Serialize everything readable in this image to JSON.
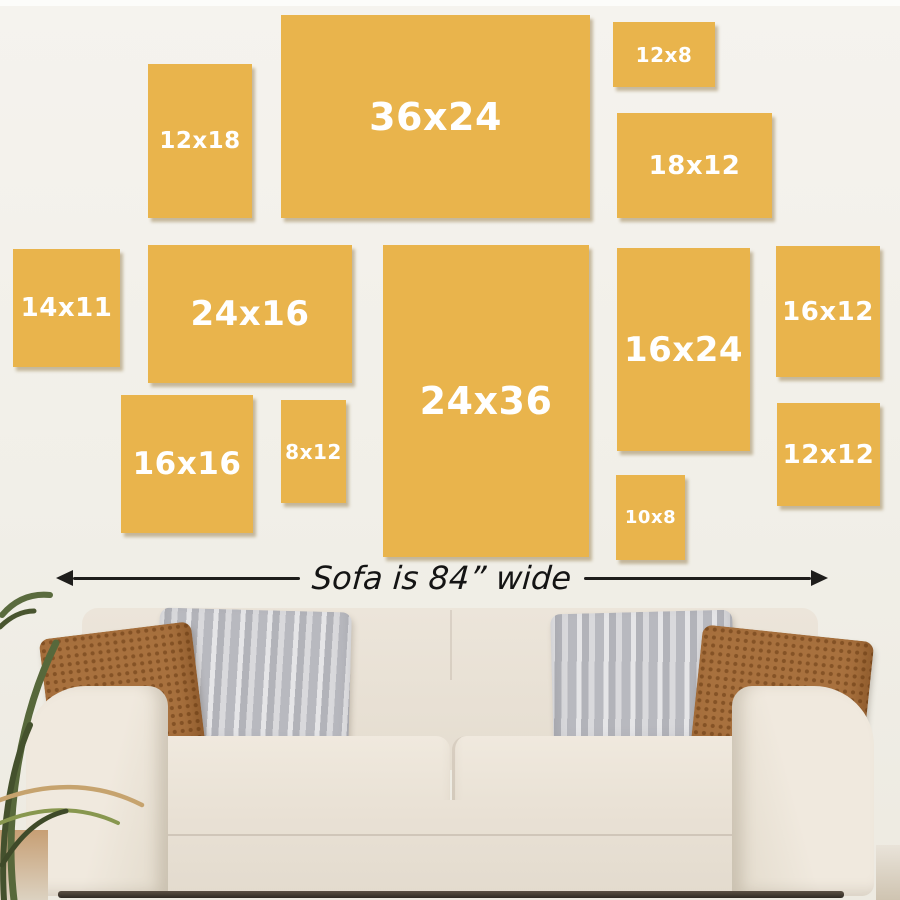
{
  "frames": [
    {
      "label": "12x18",
      "width_in": 12,
      "height_in": 18
    },
    {
      "label": "36x24",
      "width_in": 36,
      "height_in": 24
    },
    {
      "label": "12x8",
      "width_in": 12,
      "height_in": 8
    },
    {
      "label": "18x12",
      "width_in": 18,
      "height_in": 12
    },
    {
      "label": "14x11",
      "width_in": 14,
      "height_in": 11
    },
    {
      "label": "24x16",
      "width_in": 24,
      "height_in": 16
    },
    {
      "label": "24x36",
      "width_in": 24,
      "height_in": 36
    },
    {
      "label": "16x24",
      "width_in": 16,
      "height_in": 24
    },
    {
      "label": "16x12",
      "width_in": 16,
      "height_in": 12
    },
    {
      "label": "16x16",
      "width_in": 16,
      "height_in": 16
    },
    {
      "label": "8x12",
      "width_in": 8,
      "height_in": 12
    },
    {
      "label": "10x8",
      "width_in": 10,
      "height_in": 8
    },
    {
      "label": "12x12",
      "width_in": 12,
      "height_in": 12
    }
  ],
  "sofa": {
    "caption": "Sofa is 84” wide",
    "width_inches": 84
  },
  "colors": {
    "frame_fill": "#e9b44c",
    "frame_label": "#ffffff",
    "wall": "#f1efe8",
    "arrow": "#1e1d1b",
    "sofa_fabric": "#e9e2d6",
    "pillow_brown": "#a8713e",
    "pillow_gray": "#c5c5ca",
    "plant_green": "#57683b"
  }
}
